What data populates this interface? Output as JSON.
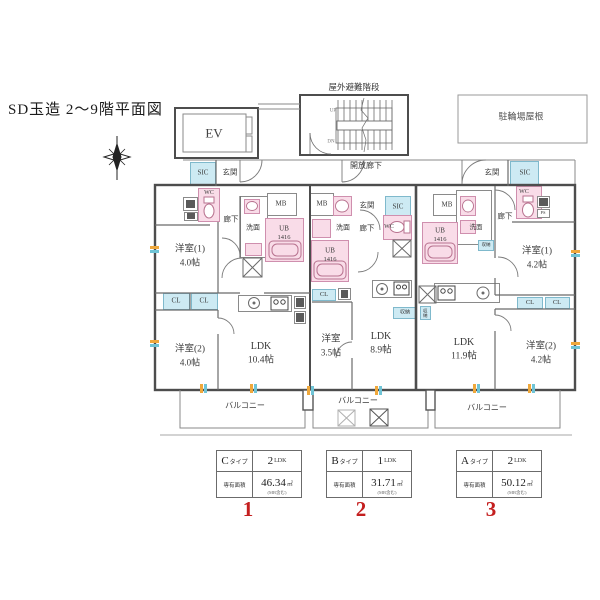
{
  "title": "SD玉造 2〜9階平面図",
  "common": {
    "ev": "EV",
    "outdoor_stairs": "屋外避難階段",
    "up": "UP",
    "dn": "DN",
    "open_corridor": "開放廊下",
    "bicycle_roof": "駐輪場屋根",
    "entrance": "玄関",
    "sic": "SIC",
    "wc": "WC",
    "mb": "MB",
    "washroom": "洗面",
    "hallway": "廊下",
    "ub": "UB",
    "ub_size": "1416",
    "cl": "CL",
    "storage": "収納",
    "ps": "PS",
    "balcony": "バルコニー"
  },
  "units": {
    "c": {
      "room1": "洋室(1)",
      "room1_size": "4.0帖",
      "room2": "洋室(2)",
      "room2_size": "4.0帖",
      "ldk": "LDK",
      "ldk_size": "10.4帖"
    },
    "b": {
      "room1": "洋室",
      "room1_size": "3.5帖",
      "ldk": "LDK",
      "ldk_size": "8.9帖"
    },
    "a": {
      "room1": "洋室(1)",
      "room1_size": "4.2帖",
      "room2": "洋室(2)",
      "room2_size": "4.2帖",
      "ldk": "LDK",
      "ldk_size": "11.9帖"
    }
  },
  "legend": {
    "area_row_label": "専有面積",
    "items": [
      {
        "type_letter": "C",
        "type_suffix": "タイプ",
        "plan_number": "2",
        "plan_suffix": "LDK",
        "area_value": "46.34",
        "area_unit": "㎡",
        "area_note": "(MB含む)",
        "index": "1"
      },
      {
        "type_letter": "B",
        "type_suffix": "タイプ",
        "plan_number": "1",
        "plan_suffix": "LDK",
        "area_value": "31.71",
        "area_unit": "㎡",
        "area_note": "(MB含む)",
        "index": "2"
      },
      {
        "type_letter": "A",
        "type_suffix": "タイプ",
        "plan_number": "2",
        "plan_suffix": "LDK",
        "area_value": "50.12",
        "area_unit": "㎡",
        "area_note": "(MB含む)",
        "index": "3"
      }
    ]
  },
  "colors": {
    "wet_area_pink": "#f9dce8",
    "closet_blue": "#cdeaf3",
    "wall": "#4d4d4d",
    "thin_line": "#8a8a8a",
    "red_number": "#c41f1f",
    "tick_orange": "#efa83c",
    "tick_cyan": "#6fc4d6"
  }
}
